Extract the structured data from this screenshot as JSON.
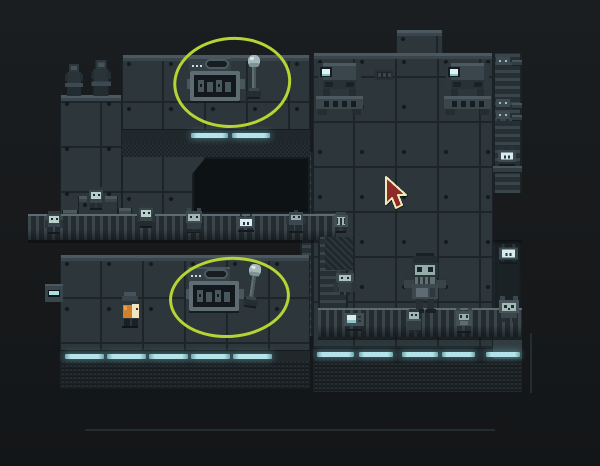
{
  "app": {
    "type": "game-screenshot",
    "description": "Dark teal pixel-art facility interior. Two lever control consoles are highlighted with hand-drawn green ellipse annotations. A red arrow mouse cursor hovers over the right wall. Small robot and cat-like creatures populate bridges, ladders and a conveyor; a large robot stands on the conveyor; the player character (orange pack, cream face, dark hat) stands in the lower-left room."
  },
  "palette": {
    "background": "#17191b",
    "wall": "#2d373b",
    "wall_highlight": "#4b585f",
    "seam": "#1d2528",
    "dither_dark": "#1c2428",
    "light_strip": "#b4e4ea",
    "annotation": "#b6d434",
    "cursor_fill": "#8e2b27",
    "cursor_outline": "#f2e9bb",
    "player_orange": "#d07f2c",
    "player_cream": "#f0e4c2",
    "creature_face": "#a3bab7"
  },
  "scene": {
    "width": 600,
    "height": 466
  },
  "entities": [
    {
      "n": "wall-upper-left-ledge",
      "t": "wall",
      "x": 60,
      "y": 95,
      "w": 62,
      "h": 141,
      "i": false
    },
    {
      "n": "wall-upper-left-tall",
      "t": "wall",
      "x": 122,
      "y": 55,
      "w": 188,
      "h": 181,
      "i": false
    },
    {
      "n": "tower-top",
      "t": "wall",
      "x": 396,
      "y": 30,
      "w": 47,
      "h": 28,
      "i": false
    },
    {
      "n": "wall-right",
      "t": "wall",
      "x": 313,
      "y": 53,
      "w": 180,
      "h": 338,
      "i": false
    },
    {
      "n": "ladder-column-right",
      "t": "ladder",
      "x": 493,
      "y": 53,
      "w": 29,
      "h": 140,
      "i": false
    },
    {
      "n": "ledge-right-1",
      "t": "wall-plain",
      "x": 512,
      "y": 60,
      "w": 10,
      "h": 6,
      "i": false
    },
    {
      "n": "ledge-right-2",
      "t": "wall-plain",
      "x": 512,
      "y": 103,
      "w": 10,
      "h": 6,
      "i": false
    },
    {
      "n": "ledge-right-3",
      "t": "wall-plain",
      "x": 512,
      "y": 115,
      "w": 10,
      "h": 6,
      "i": false
    },
    {
      "n": "ledge-right-4",
      "t": "wall-plain",
      "x": 493,
      "y": 166,
      "w": 29,
      "h": 7,
      "i": false
    },
    {
      "n": "recess-right",
      "t": "recess",
      "x": 493,
      "y": 240,
      "w": 29,
      "h": 92,
      "i": false
    },
    {
      "n": "wall-right-lower-edge",
      "t": "wall-plain",
      "x": 493,
      "y": 332,
      "w": 29,
      "h": 46,
      "i": false
    },
    {
      "n": "pillar-mid",
      "t": "ladder",
      "x": 300,
      "y": 152,
      "w": 13,
      "h": 184,
      "i": false
    },
    {
      "n": "wall-lower-left",
      "t": "wall",
      "x": 60,
      "y": 255,
      "w": 250,
      "h": 132,
      "i": false
    },
    {
      "n": "stairs-platform",
      "t": "wall",
      "x": 78,
      "y": 196,
      "w": 40,
      "h": 44,
      "i": false
    },
    {
      "n": "stair-step-1",
      "t": "wall",
      "x": 62,
      "y": 210,
      "w": 16,
      "h": 30,
      "i": false
    },
    {
      "n": "stair-step-2",
      "t": "wall",
      "x": 46,
      "y": 222,
      "w": 16,
      "h": 18,
      "i": false
    },
    {
      "n": "stair-step-3",
      "t": "wall",
      "x": 30,
      "y": 230,
      "w": 16,
      "h": 10,
      "i": false
    },
    {
      "n": "stair-step-4",
      "t": "wall",
      "x": 118,
      "y": 208,
      "w": 14,
      "h": 32,
      "i": false
    },
    {
      "n": "stair-step-5",
      "t": "wall",
      "x": 132,
      "y": 214,
      "w": 16,
      "h": 26,
      "i": false
    },
    {
      "n": "doorway",
      "t": "doorway",
      "x": 192,
      "y": 157,
      "w": 118,
      "h": 57,
      "i": false
    },
    {
      "n": "band-upper",
      "t": "band",
      "x": 122,
      "y": 129,
      "w": 188,
      "h": 14,
      "i": false
    },
    {
      "n": "dither-upper",
      "t": "dither",
      "x": 122,
      "y": 143,
      "w": 188,
      "h": 14,
      "i": false
    },
    {
      "n": "band-lower-left",
      "t": "band",
      "x": 60,
      "y": 350,
      "w": 250,
      "h": 13,
      "i": false
    },
    {
      "n": "band-lower-right",
      "t": "band",
      "x": 313,
      "y": 348,
      "w": 180,
      "h": 13,
      "i": false
    },
    {
      "n": "dither-lower-left",
      "t": "dither-fade",
      "x": 60,
      "y": 361,
      "w": 250,
      "h": 28,
      "i": false
    },
    {
      "n": "dither-lower-right",
      "t": "dither-fade",
      "x": 313,
      "y": 359,
      "w": 209,
      "h": 33,
      "i": false
    },
    {
      "n": "bridge",
      "t": "belt",
      "x": 28,
      "y": 214,
      "w": 308,
      "h": 24,
      "i": false
    },
    {
      "n": "ladder-column-inner",
      "t": "ladder",
      "x": 318,
      "y": 237,
      "w": 30,
      "h": 98,
      "i": false
    },
    {
      "n": "pillar-hatch",
      "t": "hatch",
      "x": 325,
      "y": 237,
      "w": 28,
      "h": 33,
      "i": false
    },
    {
      "n": "conveyor",
      "t": "belt",
      "x": 318,
      "y": 308,
      "w": 204,
      "h": 27,
      "i": false
    },
    {
      "n": "light-strip-a1",
      "t": "strip",
      "x": 191,
      "y": 133,
      "w": 37,
      "h": 5,
      "i": false
    },
    {
      "n": "light-strip-a2",
      "t": "strip",
      "x": 232,
      "y": 133,
      "w": 38,
      "h": 5,
      "i": false
    },
    {
      "n": "light-strip-b1",
      "t": "strip",
      "x": 65,
      "y": 354,
      "w": 39,
      "h": 5,
      "i": false
    },
    {
      "n": "light-strip-b2",
      "t": "strip",
      "x": 107,
      "y": 354,
      "w": 39,
      "h": 5,
      "i": false
    },
    {
      "n": "light-strip-b3",
      "t": "strip",
      "x": 149,
      "y": 354,
      "w": 39,
      "h": 5,
      "i": false
    },
    {
      "n": "light-strip-b4",
      "t": "strip",
      "x": 191,
      "y": 354,
      "w": 39,
      "h": 5,
      "i": false
    },
    {
      "n": "light-strip-b5",
      "t": "strip",
      "x": 233,
      "y": 354,
      "w": 39,
      "h": 5,
      "i": false
    },
    {
      "n": "light-strip-c1",
      "t": "strip",
      "x": 317,
      "y": 352,
      "w": 37,
      "h": 5,
      "i": false
    },
    {
      "n": "light-strip-c2",
      "t": "strip",
      "x": 359,
      "y": 352,
      "w": 34,
      "h": 5,
      "i": false
    },
    {
      "n": "light-strip-c3",
      "t": "strip",
      "x": 402,
      "y": 352,
      "w": 36,
      "h": 5,
      "i": false
    },
    {
      "n": "light-strip-c4",
      "t": "strip",
      "x": 442,
      "y": 352,
      "w": 33,
      "h": 5,
      "i": false
    },
    {
      "n": "light-strip-c5",
      "t": "strip",
      "x": 486,
      "y": 352,
      "w": 34,
      "h": 5,
      "i": false
    },
    {
      "n": "wall-switch",
      "t": "switch",
      "x": 45,
      "y": 284,
      "w": 18,
      "h": 18,
      "i": true
    },
    {
      "n": "vent-panel",
      "t": "vent",
      "x": 375,
      "y": 70,
      "w": 18,
      "h": 10,
      "i": false
    },
    {
      "n": "lever-console-top",
      "t": "machine-panel",
      "x": 187,
      "y": 57,
      "w": 58,
      "h": 46,
      "i": true
    },
    {
      "n": "lever-top",
      "t": "lever",
      "x": 245,
      "y": 55,
      "w": 18,
      "h": 46,
      "i": true
    },
    {
      "n": "lever-console-bottom",
      "t": "machine-panel",
      "x": 186,
      "y": 267,
      "w": 58,
      "h": 46,
      "i": true
    },
    {
      "n": "lever-bottom",
      "t": "lever",
      "x": 246,
      "y": 264,
      "w": 18,
      "h": 46,
      "r": 8,
      "i": true
    },
    {
      "n": "fabricator-left",
      "t": "console",
      "x": 316,
      "y": 63,
      "w": 47,
      "h": 52,
      "i": true
    },
    {
      "n": "fabricator-right",
      "t": "console",
      "x": 444,
      "y": 63,
      "w": 47,
      "h": 52,
      "i": true
    },
    {
      "n": "statue-1",
      "t": "statue",
      "x": 62,
      "y": 62,
      "w": 24,
      "h": 34,
      "i": true
    },
    {
      "n": "statue-2",
      "t": "statue",
      "x": 88,
      "y": 58,
      "w": 26,
      "h": 38,
      "i": true
    },
    {
      "n": "creature-pale-1",
      "t": "pale-creature",
      "x": 44,
      "y": 208,
      "w": 20,
      "h": 26,
      "i": true
    },
    {
      "n": "creature-pale-2",
      "t": "pale-creature",
      "x": 86,
      "y": 184,
      "w": 20,
      "h": 26,
      "i": true
    },
    {
      "n": "creature-pale-3",
      "t": "pale-creature",
      "x": 136,
      "y": 202,
      "w": 20,
      "h": 26,
      "i": true
    },
    {
      "n": "creature-cat-bridge",
      "t": "cat-creature",
      "x": 183,
      "y": 207,
      "w": 22,
      "h": 26,
      "i": true
    },
    {
      "n": "creature-tv-bridge",
      "t": "tv-creature",
      "x": 235,
      "y": 214,
      "w": 22,
      "h": 18,
      "i": true
    },
    {
      "n": "creature-robot-bridge",
      "t": "robot-small",
      "x": 286,
      "y": 210,
      "w": 20,
      "h": 23,
      "i": true
    },
    {
      "n": "creature-round",
      "t": "round-creature",
      "x": 331,
      "y": 210,
      "w": 20,
      "h": 23,
      "i": true
    },
    {
      "n": "creature-crouch-1",
      "t": "crouch-creature",
      "x": 494,
      "y": 56,
      "w": 18,
      "h": 11,
      "i": true
    },
    {
      "n": "creature-crouch-2",
      "t": "crouch-creature",
      "x": 494,
      "y": 98,
      "w": 18,
      "h": 11,
      "i": true
    },
    {
      "n": "creature-crouch-3",
      "t": "crouch-creature",
      "x": 494,
      "y": 110,
      "w": 18,
      "h": 11,
      "i": true
    },
    {
      "n": "creature-tv-ladder",
      "t": "tv-creature",
      "x": 496,
      "y": 147,
      "w": 22,
      "h": 19,
      "i": true
    },
    {
      "n": "creature-tv-right",
      "t": "tv-creature",
      "x": 497,
      "y": 244,
      "w": 23,
      "h": 20,
      "i": true
    },
    {
      "n": "creature-hanging",
      "t": "hang-creature",
      "x": 333,
      "y": 270,
      "w": 24,
      "h": 26,
      "i": true
    },
    {
      "n": "creature-radio",
      "t": "radio-creature",
      "x": 342,
      "y": 311,
      "w": 24,
      "h": 20,
      "i": true
    },
    {
      "n": "robot-big",
      "t": "robot-big",
      "x": 402,
      "y": 253,
      "w": 46,
      "h": 62,
      "i": true
    },
    {
      "n": "creature-robe",
      "t": "robe-creature",
      "x": 404,
      "y": 309,
      "w": 20,
      "h": 24,
      "i": true
    },
    {
      "n": "creature-frog",
      "t": "frog-creature",
      "x": 454,
      "y": 306,
      "w": 20,
      "h": 27,
      "i": true
    },
    {
      "n": "creature-bigcat",
      "t": "big-cat",
      "x": 497,
      "y": 296,
      "w": 24,
      "h": 27,
      "i": true
    },
    {
      "n": "player-character",
      "t": "player",
      "x": 116,
      "y": 291,
      "w": 28,
      "h": 38,
      "i": true
    },
    {
      "n": "floor-hint-line",
      "t": "line-faint",
      "x": 85,
      "y": 429,
      "w": 410,
      "h": 2,
      "i": false
    },
    {
      "n": "wall-edge-line",
      "t": "line-faint",
      "x": 530,
      "y": 333,
      "w": 2,
      "h": 60,
      "i": false
    },
    {
      "n": "annotation-ellipse-top",
      "t": "ellipse-annotation",
      "x": 171,
      "y": 37,
      "w": 112,
      "h": 85,
      "r": -4,
      "i": false
    },
    {
      "n": "annotation-ellipse-bottom",
      "t": "ellipse-annotation",
      "x": 167,
      "y": 257,
      "w": 115,
      "h": 75,
      "r": -4,
      "i": false
    },
    {
      "n": "mouse-cursor",
      "t": "cursor",
      "x": 383,
      "y": 176,
      "w": 24,
      "h": 34,
      "i": false
    }
  ]
}
